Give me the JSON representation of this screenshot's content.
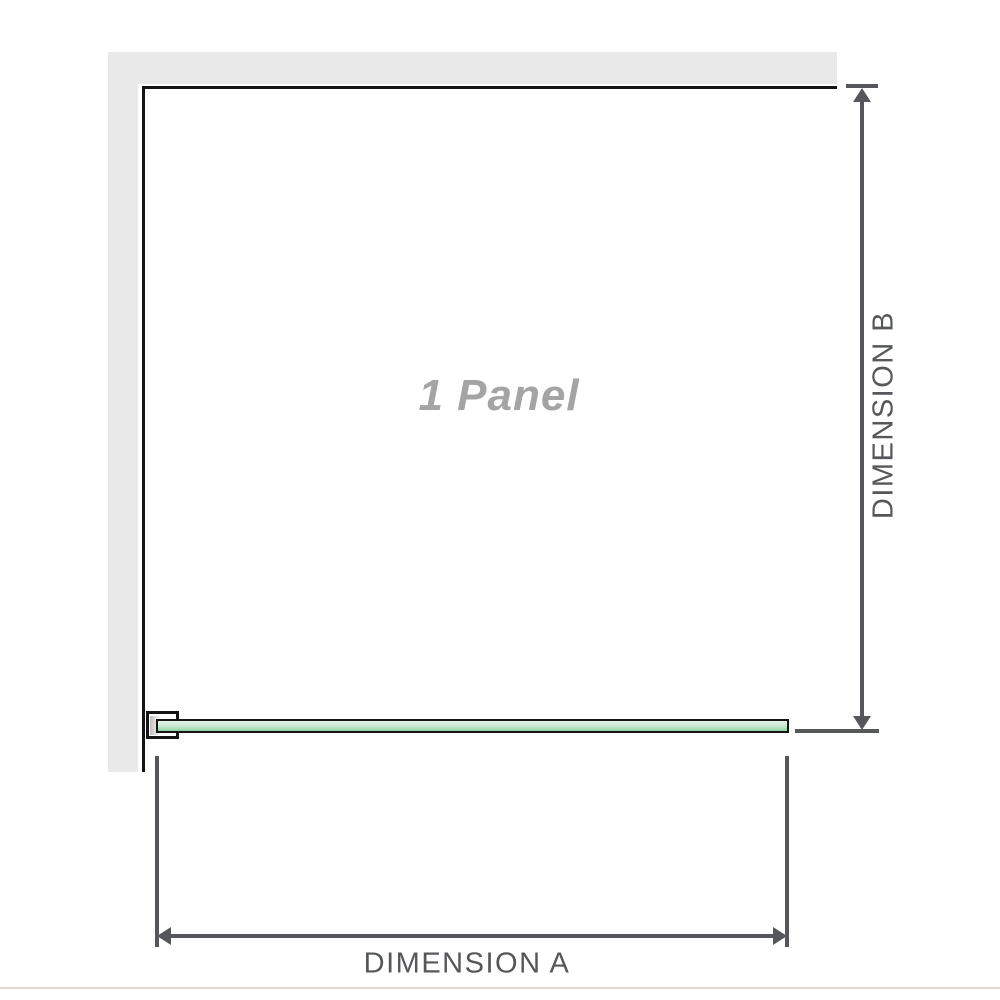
{
  "labels": {
    "panel": "1 Panel",
    "dimension_a": "DIMENSION A",
    "dimension_b": "DIMENSION B"
  },
  "colors": {
    "wall": "#e9e9e9",
    "outline": "#141414",
    "glass_light": "#e3f3e8",
    "glass_mid": "#cdead7",
    "glass_dark": "#93d2a4",
    "bracket_shade": "#bfbfbf",
    "dimension": "#55575a",
    "panel_text": "#a4a4a4",
    "floor_line": "#ddd9d0"
  }
}
